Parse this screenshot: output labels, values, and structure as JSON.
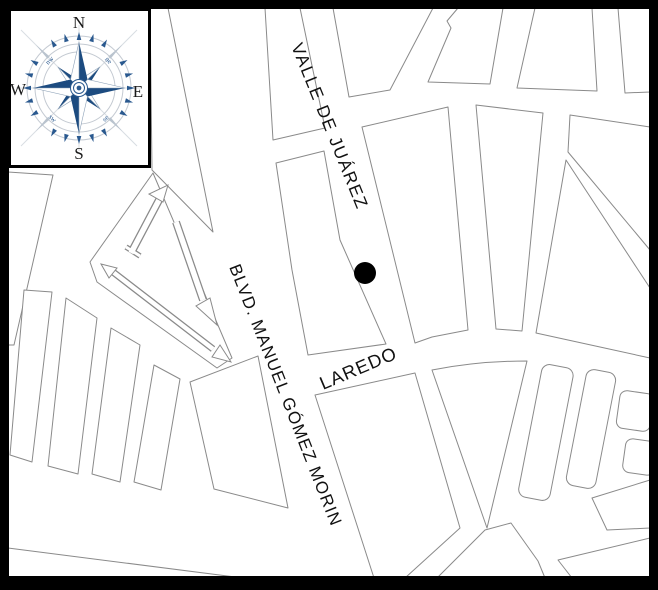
{
  "map": {
    "colors": {
      "background": "#ffffff",
      "block_outline": "#8a8a8a",
      "frame": "#000000",
      "marker": "#000000"
    },
    "streets": [
      {
        "name": "VALLE DE JUÁREZ"
      },
      {
        "name": "LAREDO"
      },
      {
        "name": "BLVD. MANUEL GÓMEZ MORIN"
      }
    ],
    "marker": {
      "shape": "filled-circle",
      "on_street": "VALLE DE JUÁREZ",
      "x": 365,
      "y": 273,
      "radius": 11
    },
    "ramp_arrows_count": 3
  },
  "compass": {
    "colors": {
      "rose": "#1c4b80",
      "rose_light": "#2a598f",
      "ring": "#c4cad2"
    },
    "cardinals": {
      "north": "N",
      "east": "E",
      "south": "S",
      "west": "W"
    },
    "intercardinals": {
      "northwest": "nw",
      "northeast": "ne",
      "southwest": "sw",
      "southeast": "se"
    }
  }
}
